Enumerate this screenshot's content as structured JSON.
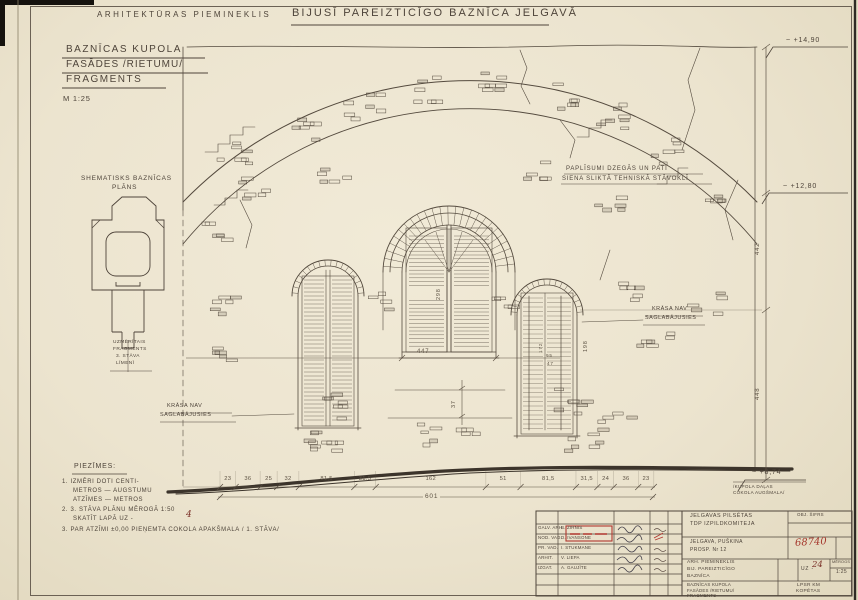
{
  "sheet": {
    "header": {
      "left": "ARHITEKTŪRAS PIEMINEKLIS",
      "right": "BIJUSĪ PAREIZTICĪGO BAZNĪCA JELGAVĀ"
    },
    "title_box": {
      "line1": "BAZNĪCAS KUPOLA",
      "line2": "FASĀDES /RIETUMU/",
      "line3": "FRAGMENTS",
      "scale": "M 1:25"
    },
    "plan": {
      "label1": "SHEMATISKS BAZNĪCAS",
      "label2": "PLĀNS",
      "note1": "UZMĒRĪTAIS",
      "note2": "FRAGMENTS",
      "note3": "3. STĀVA",
      "note4": "LĪMENĪ"
    },
    "annotations": {
      "crack1": "PAPLĪSUMI DZEGĀS UN PATI",
      "crack2": "SIENA SLIKTĀ TEHNISKĀ STĀVOKLĪ",
      "np_a1": "KRĀSA NAV",
      "np_a2": "SAGLABĀJUSIES",
      "np_b1": "KRĀSA NAV",
      "np_b2": "SAGLABĀJUSIES"
    },
    "elevations": {
      "top": "~ +14,90",
      "mid": "~ +12,80",
      "socle": "~ +8,74",
      "socle_note1": "/KUPOLA DAĻAS",
      "socle_note2": "COKOLA AUGŠMALA/"
    },
    "dimensions": {
      "chain": [
        "23",
        "36",
        "25",
        "32",
        "81,5",
        "31,5",
        "162",
        "51",
        "81,5",
        "31,5",
        "24",
        "36",
        "23"
      ],
      "total": "601",
      "center_width": "447",
      "center_sash": "298",
      "plinth": "37",
      "right_h1": "172",
      "right_h2": "95",
      "right_h3": "47",
      "right_side": "198",
      "v_upper": "442",
      "v_lower": "448"
    },
    "notes": {
      "title": "PIEZĪMES:",
      "n1a": "1. IZMĒRI DOTI CENTI-",
      "n1b": "METROS — AUGSTUMU",
      "n1c": "ATZĪMES — METROS",
      "n2a": "2. 3. STĀVA PLĀNU MĒROGĀ 1:50",
      "n2b": "SKATĪT LAPĀ UZ -",
      "n2_page": "4",
      "n3": "3. PAR ATZĪMI ±0,00 PIEŅEMTA COKOLA APAKŠMALA / 1. STĀVA/"
    },
    "title_block": {
      "org1": "JELGAVAS PILSĒTAS",
      "org2": "TDP IZPILDKOMITEJA",
      "obj_cipher_label": "OBJ. ŠIFRS",
      "addr1": "JELGAVA, PUŠKINA",
      "addr2": "PROSP. Nr 12",
      "stamp_number": "68740",
      "proj1": "ARH. PIEMINEKLIS",
      "proj2": "BIJ. PAREIZTICĪGO",
      "proj3": "BAZNĪCA",
      "sheet_label": "UZ -",
      "sheet_number": "24",
      "scale_label": "MĒROGS",
      "scale_value": "1:25",
      "draw1": "BAZNĪCAS KUPOLA",
      "draw2": "FASĀDES /RIETUMU/",
      "draw3": "FRAGMENTS",
      "archive1": "LPSR KM",
      "archive2": "KOPĒTAS",
      "staff": [
        {
          "role": "GALV. ARH.",
          "name": "B. ZIRNIS"
        },
        {
          "role": "NOD. VAD.",
          "name": "D. IVANSONE"
        },
        {
          "role": "PR. VAD.",
          "name": "I. STUKMANE"
        },
        {
          "role": "ARHIT.",
          "name": "V. LIEPA"
        },
        {
          "role": "IZGAT.",
          "name": "A. GAUJĪTE"
        }
      ]
    },
    "colors": {
      "paper": "#ece4cf",
      "ink": "#4e443a",
      "red": "#a5372c"
    }
  }
}
